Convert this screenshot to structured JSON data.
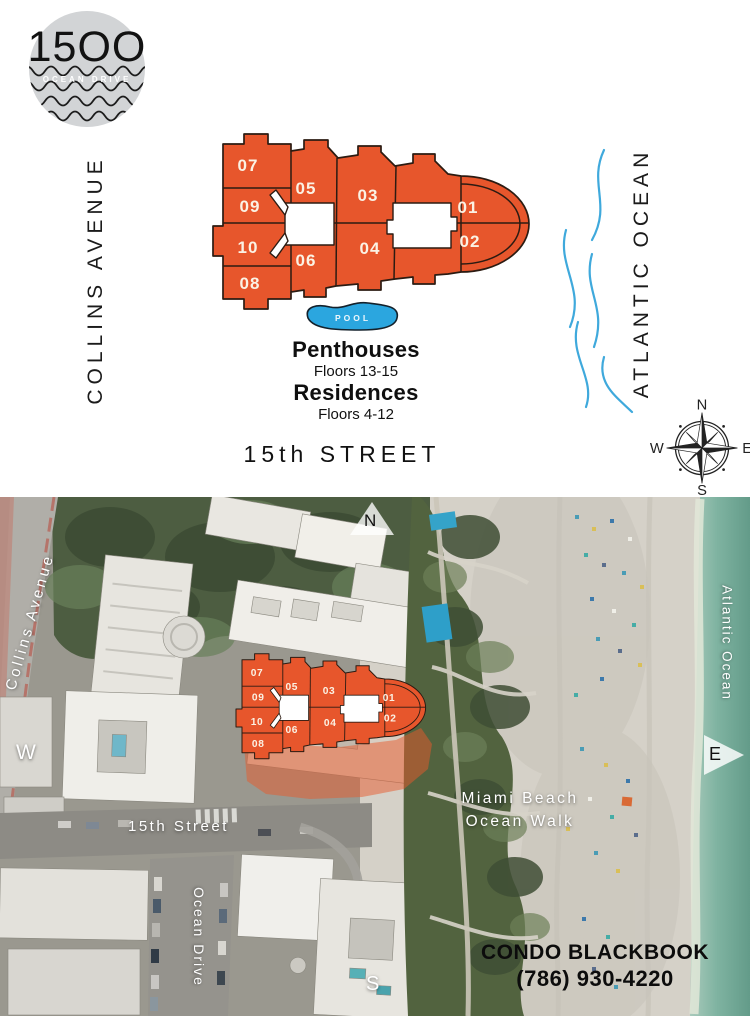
{
  "brand": {
    "number": "15OO",
    "subtitle": "OCEAN DRIVE"
  },
  "plan": {
    "streets": {
      "collins": "COLLINS AVENUE",
      "fifteenth": "15th STREET"
    },
    "water": "ATLANTIC OCEAN",
    "pool": "POOL",
    "units": {
      "u01": "01",
      "u02": "02",
      "u03": "03",
      "u04": "04",
      "u05": "05",
      "u06": "06",
      "u07": "07",
      "u08": "08",
      "u09": "09",
      "u10": "10"
    },
    "legend": {
      "penthouses": "Penthouses",
      "penthouses_floors": "Floors 13-15",
      "residences": "Residences",
      "residences_floors": "Floors 4-12"
    },
    "compass": {
      "n": "N",
      "e": "E",
      "s": "S",
      "w": "W"
    }
  },
  "aerial": {
    "labels": {
      "collins": "Collins Avenue",
      "atlantic": "Atlantic Ocean",
      "fifteenth": "15th Street",
      "ocean_drive": "Ocean Drive",
      "walk1": "Miami Beach",
      "walk2": "Ocean Walk"
    },
    "compass": {
      "n": "N",
      "e": "E",
      "s": "S",
      "w": "W"
    },
    "credit": {
      "line1_a": "CONDO",
      "line1_b": "BLACKBOOK",
      "phone": "(786) 930-4220"
    }
  },
  "colors": {
    "accent_orange": "#E7562C",
    "pool_blue": "#2BA6DF",
    "wave_blue": "#3FA9DC",
    "ocean_teal": "#7FB3A1"
  }
}
